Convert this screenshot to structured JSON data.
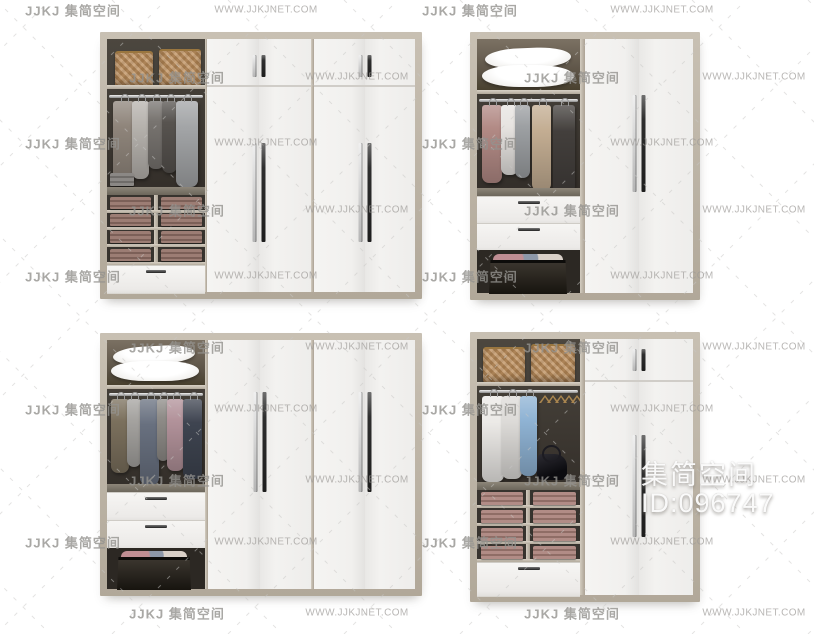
{
  "watermarks": {
    "brand_full": "JJKJ 集简空间",
    "site_url": "WWW.JJKJNET.COM",
    "big_title": "集简空间",
    "big_id": "ID:096747"
  },
  "palette": {
    "frameWood": "#c8c0b3",
    "frameWoodDark": "#b1a899",
    "doorWhite": "#f2f1ef",
    "seamGrey": "#d0cdc8",
    "interiorDark": "#3c3833",
    "interiorBrown": "#7b7163",
    "floorGrey": "#837b6f",
    "handleDark": "#2e2e2e",
    "handleLight": "#c9c9c9",
    "basket": "#c49a6c",
    "basketRim": "#9a763f",
    "pillowWhite": "#fafaf9",
    "stackMauve1": "#9c7d74",
    "stackMauve2": "#7c6058",
    "stackRose1": "#b18c86",
    "stackRose2": "#8f6d66",
    "stackGrey1": "#8b8885",
    "stackGrey2": "#6f6c69",
    "boxDark": "#211e1a",
    "bagBlack": "#16151a",
    "hangerWood": "#a8854f",
    "watermarkGrey": "#9a9896",
    "bigWatermarkWhite": "#fdfdfd",
    "gA1": "#8f857b",
    "gA2": "#b7b3ae",
    "gA3": "#787470",
    "gA4": "#57534f",
    "gA5": "#a3a5a7",
    "gB1": "#b28a85",
    "gB2": "#e7e4e1",
    "gB3": "#9da0a3",
    "gB4": "#c3ad92",
    "gB5": "#433f3c",
    "gC1": "#7b705d",
    "gC2": "#a5a3a0",
    "gC3": "#68707f",
    "gC4": "#b2929a",
    "gC5": "#3e4450",
    "gC6": "#8f8c88",
    "gD1": "#eceae7",
    "gD2": "#dddbd8",
    "gD3": "#8fb3d4"
  }
}
